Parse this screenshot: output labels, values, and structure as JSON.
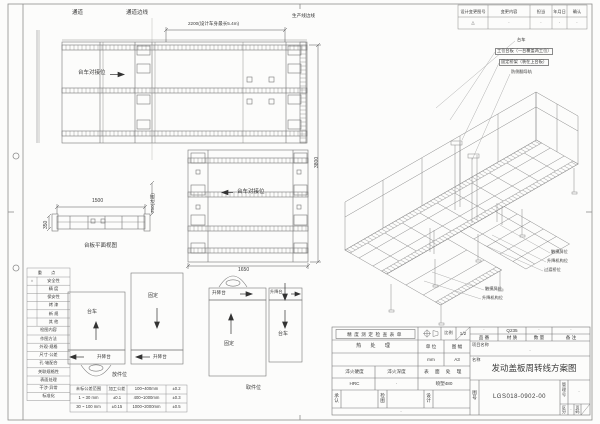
{
  "accent": {
    "line_color": "#777777",
    "text_color": "#3a3a3a",
    "paper_color": "#fcfcfb"
  },
  "revision_table": {
    "headers": [
      "设计变更图号",
      "变更内容",
      "担当",
      "年月日",
      "确认"
    ],
    "values": [
      "△",
      "·",
      "·",
      "·",
      "·"
    ]
  },
  "plan_labels": {
    "aisle": "通道",
    "aisle_edge": "通道边线",
    "prod_edge": "生产线边线",
    "dock1": "台车对接位",
    "dock2": "台车对接位",
    "side_caption": "台板平面视图"
  },
  "dims": {
    "d2200": "2200(设计车身最长5.4m)",
    "d3800": "3800",
    "d1500": "1500",
    "d350": "350",
    "d750": "750(过道)",
    "d1650": "1650"
  },
  "iso_callouts": {
    "c1": "台车",
    "c2": "工位台板（一台覆盖两工位）",
    "c3": "固定桥架（装在上台板）",
    "c4": "防侧翻导轨",
    "r1": "触摸屏位",
    "r2": "升降机构位",
    "r3": "过渡桥位",
    "l1": "触摸屏位",
    "l2": "升降机构位"
  },
  "schematics": {
    "a_main": "台车",
    "a_strip": "升降台",
    "b_main": "固定",
    "b_strip": "升降台",
    "c_main": "固定",
    "c_strip": "升降台",
    "d_main": "台车",
    "d_strip": "升降台",
    "station_left": "放件位",
    "station_right": "取件位"
  },
  "check_table": {
    "header1": "重 点",
    "rows1": [
      {
        "mark": "○",
        "label": "安全性"
      },
      {
        "mark": "",
        "label": "精 度"
      },
      {
        "mark": "",
        "label": "保安性"
      },
      {
        "mark": "",
        "label": "烤 漆"
      },
      {
        "mark": "",
        "label": "新 规"
      },
      {
        "mark": "",
        "label": "其 他"
      }
    ],
    "header2": "检图内容",
    "rows2": [
      "作图方法",
      "外观·规格",
      "尺寸·公差",
      "孔·轴配合",
      "关联规格性",
      "表面处理",
      "干涉·异常",
      "标准化"
    ]
  },
  "tolerance_table": {
    "rows": [
      [
        "未标公差范围",
        "加工公差",
        "100~400mm",
        "±0.2"
      ],
      [
        "1 ~ 30 mm",
        "±0.1",
        "400~1000mm",
        "±0.3"
      ],
      [
        "30 ~ 100 mm",
        "±0.15",
        "1000~2000mm",
        "±0.5"
      ]
    ]
  },
  "title_block": {
    "check_sheet": "精度测定检查表单",
    "scale_label": "比例",
    "scale_value": "1/2",
    "heat_label": "热 处 理",
    "unit_label": "单 位",
    "unit_value": "mm",
    "sheet_label": "图 幅",
    "sheet_value": "A3",
    "quench_hard_label": "淬火硬度",
    "quench_hard_value": "HRC",
    "quench_depth_label": "淬火深度",
    "quench_depth_value": "·",
    "surface_label": "表 面 处 理",
    "surface_value": "喷塑480",
    "approve_label": "承认",
    "review_label": "检图",
    "design_label": "设计",
    "footer_value": "·",
    "part_no_label": "品 番",
    "part_no_value": "·",
    "material_label": "材 质",
    "material_value": "Q235",
    "qty_label": "数 量",
    "qty_value": "·",
    "remark_label": "备 注",
    "remark_value": "·",
    "project_label": "项目名称",
    "project_value": "·",
    "name_label": "名称",
    "drawing_title": "发动盖板周转线方案图",
    "dwg_no_label": "图号",
    "dwg_no": "LGS018-0902-00",
    "mgmt_label": "管理号",
    "mgmt_value": "·",
    "class_label": "区分",
    "class_value": "·",
    "page_label": "页码"
  }
}
